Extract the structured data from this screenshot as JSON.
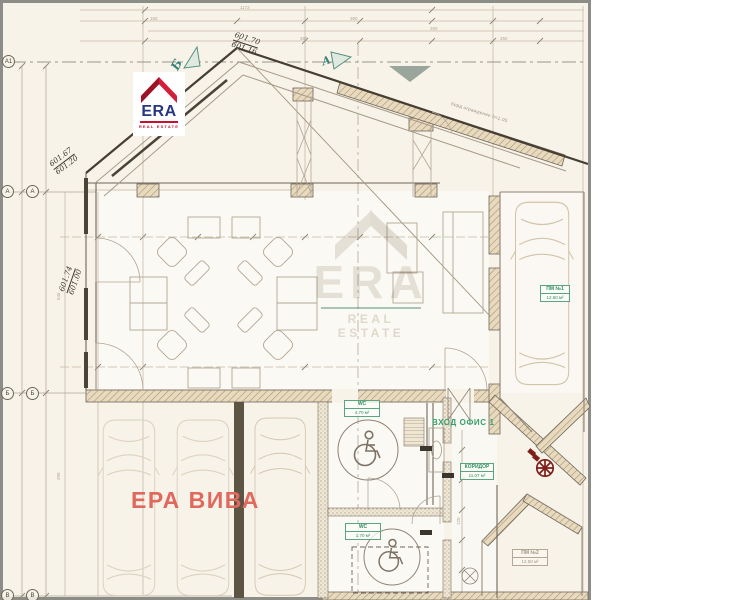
{
  "brand": {
    "logo": {
      "name": "ERA",
      "tagline": "REAL ESTATE"
    },
    "watermark": {
      "name": "ERA",
      "tagline": "REAL ESTATE"
    }
  },
  "title": {
    "text": "ЕРА ВИВА"
  },
  "entrance_label": "ВХОД ОФИС 1",
  "elevations": {
    "ridge_top": "601.70",
    "ridge_bottom": "601.16",
    "eave_left_top": "601.67",
    "eave_left_bottom": "601.20",
    "side_left_top": "601.74",
    "side_left_bottom": "601.00"
  },
  "axes": {
    "a1": "А1",
    "a": "А",
    "b": "Б",
    "v": "В"
  },
  "section_markers": {
    "left": "Б",
    "right": "А"
  },
  "rooms": {
    "wc1": {
      "name": "WC",
      "area": "4.70 м²"
    },
    "wc2": {
      "name": "WC",
      "area": "1.70 м²"
    },
    "corridor": {
      "name": "КОРИДОР",
      "area": "11.07 м²"
    },
    "parking_right": {
      "name": "ПМ №1",
      "area": "12.50 м²"
    },
    "parking_lower": {
      "name": "ПМ №2",
      "area": "12.50 м²"
    }
  },
  "roof_note": "борд ограждение h=1.05",
  "dims": {
    "d1": "1172",
    "d2": "545",
    "d3": "390",
    "d4": "260",
    "d5": "250",
    "d6": "150",
    "d7": "385",
    "d8": "120"
  },
  "colors": {
    "accent_green": "#35a06a",
    "accent_red": "#e0695e",
    "logo_red": "#c41230",
    "logo_navy": "#26367f",
    "paper": "#f7f3e9"
  }
}
